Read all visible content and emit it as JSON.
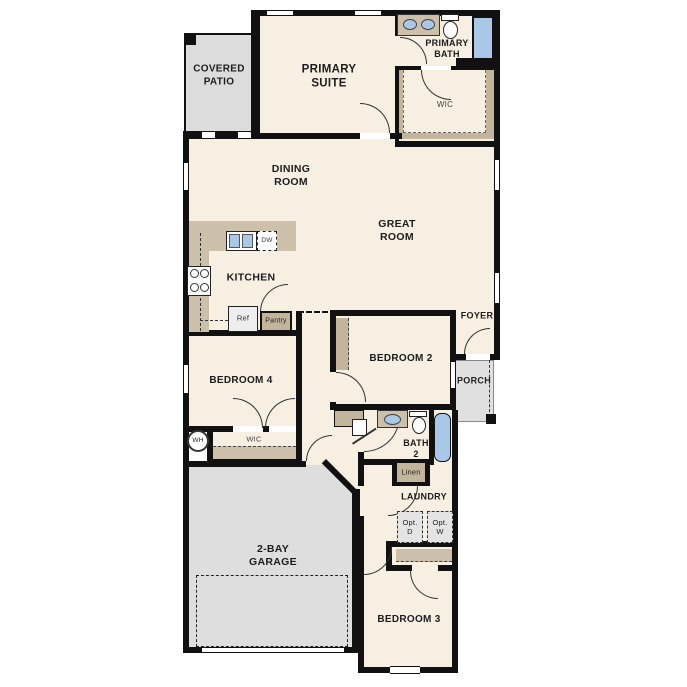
{
  "rooms": {
    "covered_patio": "COVERED\nPATIO",
    "primary_suite": "PRIMARY\nSUITE",
    "primary_bath": "PRIMARY\nBATH",
    "primary_wic": "WIC",
    "dining_room": "DINING\nROOM",
    "great_room": "GREAT\nROOM",
    "kitchen": "KITCHEN",
    "bedroom_4": "BEDROOM 4",
    "bedroom_4_wic": "WIC",
    "bedroom_2": "BEDROOM 2",
    "foyer": "FOYER",
    "porch": "PORCH",
    "bath_2": "BATH\n2",
    "linen": "Linen",
    "laundry": "LAUNDRY",
    "garage": "2-BAY\nGARAGE",
    "bedroom_3": "BEDROOM 3"
  },
  "fixtures": {
    "refrigerator": "Ref",
    "pantry": "Pantry",
    "dishwasher": "DW",
    "water_heater": "WH",
    "optional_dryer": "Opt.\nD",
    "optional_washer": "Opt.\nW"
  },
  "colors": {
    "wall": "#111111",
    "floor": "#f6efe2",
    "cabinet_tan": "#c8bba2",
    "concrete_gray": "#dcdcdc",
    "fixture_blue": "#a9c8e8"
  }
}
